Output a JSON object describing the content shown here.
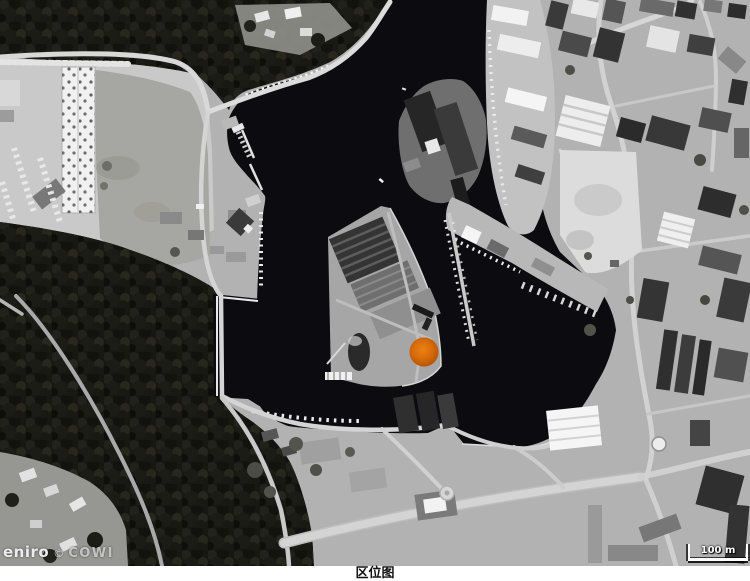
{
  "figure": {
    "caption": "区位图"
  },
  "map": {
    "kind": "grayscale-aerial-photo-of-harbor",
    "watermark": {
      "brand": "eniro",
      "separator": "©",
      "provider": "COWI"
    },
    "scale_bar": {
      "label": "100 m"
    },
    "marker": {
      "shape": "circle",
      "color": "#D2650A",
      "description": "orange site-location dot on central harbor pier"
    },
    "palette": {
      "water": "#0b0b10",
      "forest": "#1a1a15",
      "land": "#b2b2b2",
      "road": "#d6d6d6",
      "building_light": "#f0f0f0",
      "building_dark": "#2c2c2c",
      "marker_orange": "#D2650A"
    }
  }
}
